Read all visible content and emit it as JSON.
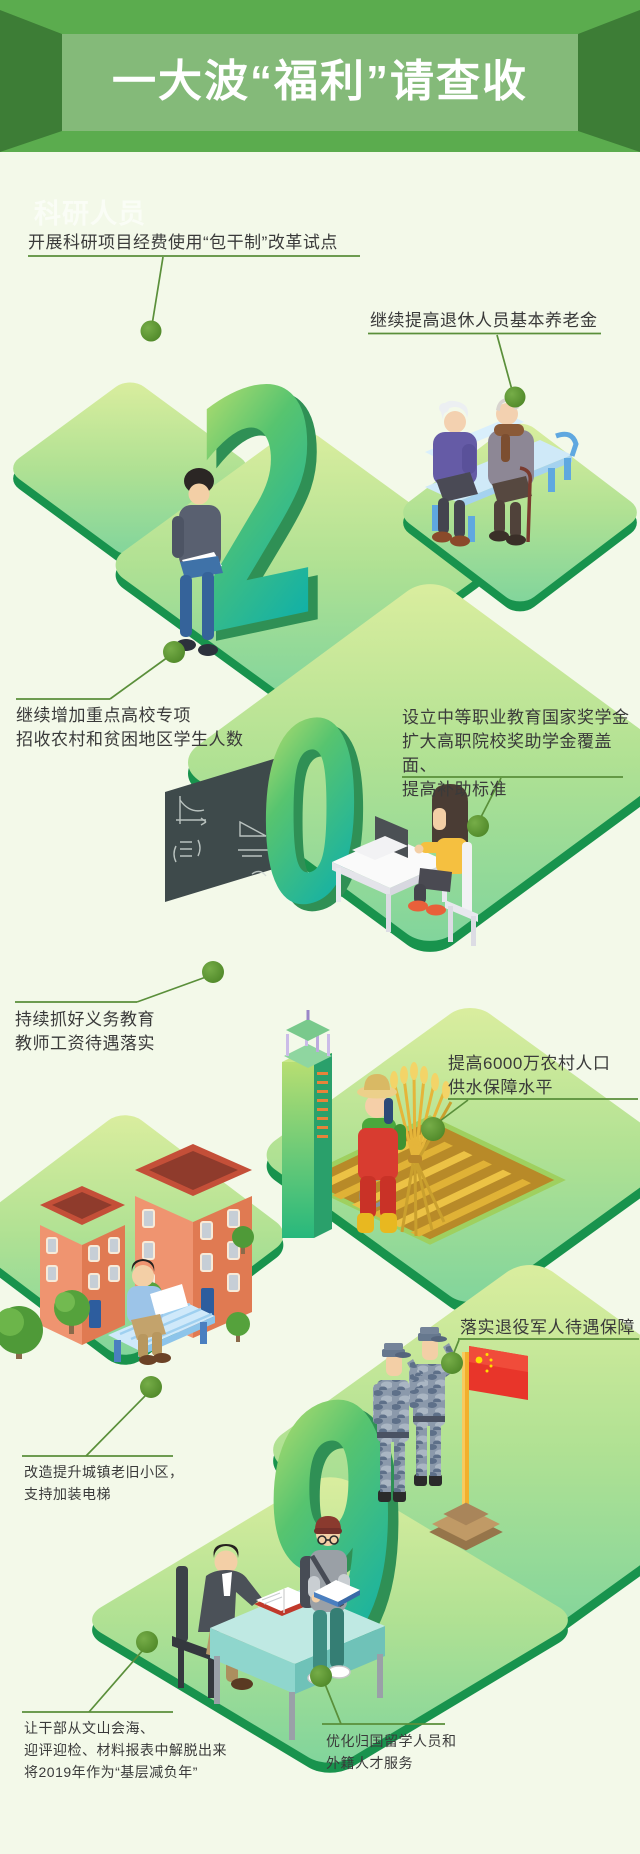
{
  "header": {
    "title": "一大波“福利”请查收"
  },
  "watermark": {
    "label": "科研人员"
  },
  "year": "2019",
  "year_digits": {
    "two": "2",
    "zero": "0",
    "one": "1",
    "nine": "9"
  },
  "callouts": [
    {
      "id": "research-funding",
      "lines": [
        "开展科研项目经费使用“包干制”改革试点"
      ]
    },
    {
      "id": "pension-increase",
      "lines": [
        "继续提高退休人员基本养老金"
      ]
    },
    {
      "id": "college-special-admission",
      "lines": [
        "继续增加重点高校专项",
        "招收农村和贫困地区学生人数"
      ]
    },
    {
      "id": "vocational-scholarship",
      "lines": [
        "设立中等职业教育国家奖学金",
        "扩大高职院校奖助学金覆盖面、",
        "提高补助标准"
      ]
    },
    {
      "id": "teacher-salary",
      "lines": [
        "持续抓好义务教育",
        "教师工资待遇落实"
      ]
    },
    {
      "id": "rural-water-supply",
      "lines": [
        "提高6000万农村人口",
        "供水保障水平"
      ]
    },
    {
      "id": "veterans-benefits",
      "lines": [
        "落实退役军人待遇保障"
      ]
    },
    {
      "id": "old-residential-renewal",
      "lines": [
        "改造提升城镇老旧小区，",
        "支持加装电梯"
      ]
    },
    {
      "id": "grassroots-burden-relief",
      "lines": [
        "让干部从文山会海、",
        "迎评迎检、材料报表中解脱出来",
        "将2019年作为“基层减负年”"
      ]
    },
    {
      "id": "overseas-talent-service",
      "lines": [
        "优化归国留学人员和",
        "外籍人才服务"
      ]
    }
  ],
  "colors": {
    "banner_green": "#5bac4e",
    "banner_dark": "#3d7d36",
    "banner_light": "#84ba79",
    "background": "#f3f9e9",
    "platform_edge": "#18934d",
    "callout_line": "#5a8f3a",
    "callout_dot": "#4c8526",
    "flag_red": "#e8352a",
    "digit_green": "#57c46f"
  }
}
